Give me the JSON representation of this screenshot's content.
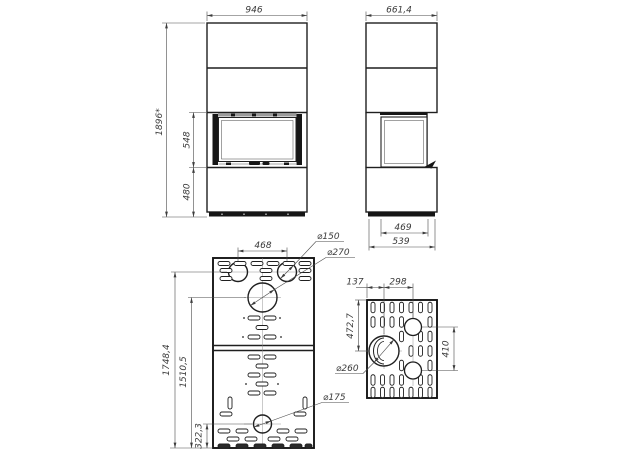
{
  "drawing": {
    "front": {
      "width": "946",
      "height": "1896*",
      "firebox_height": "548",
      "base_height": "480"
    },
    "side": {
      "depth": "661,4",
      "glass_depth": "469",
      "base_depth": "539"
    },
    "back_panel": {
      "flue_spacing": "468",
      "flue_d150": "⌀150",
      "flue_d270": "⌀270",
      "height_flue150": "1748,4",
      "height_flue270": "1510,5",
      "height_flue175": "322,3",
      "flue_d175": "⌀175"
    },
    "side_panel": {
      "offset_front": "137",
      "spacing_h": "298",
      "height_center": "472,7",
      "spacing_v": "410",
      "flue_d260": "⌀260"
    }
  }
}
